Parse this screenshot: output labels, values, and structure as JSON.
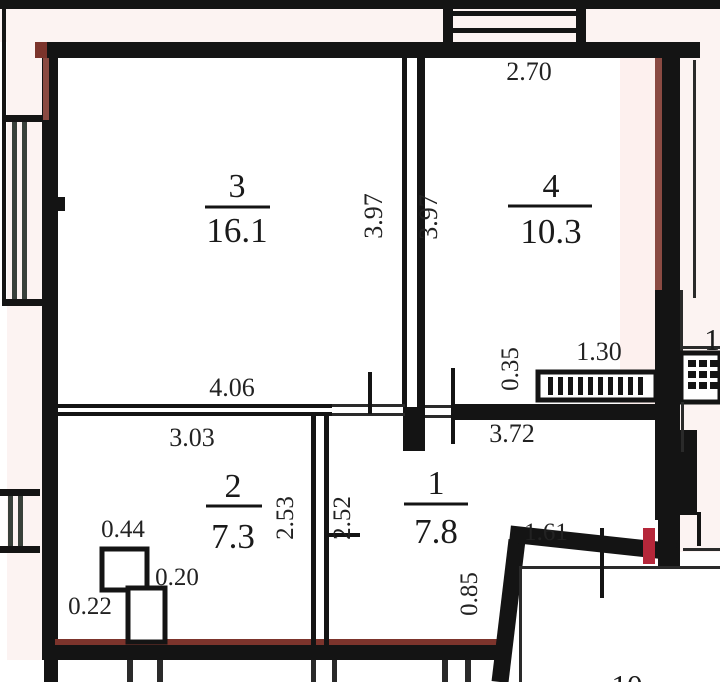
{
  "plan_title": "apartment-floor-plan",
  "rooms": {
    "r3": {
      "number": "3",
      "area": "16.1"
    },
    "r4": {
      "number": "4",
      "area": "10.3"
    },
    "r2": {
      "number": "2",
      "area": "7.3"
    },
    "r1": {
      "number": "1",
      "area": "7.8"
    }
  },
  "dims": {
    "top_room4_width": "2.70",
    "wall34_left_height": "3.97",
    "wall34_right_height": "3.97",
    "room3_width": "4.06",
    "room2_width": "3.03",
    "vent_width": "1.30",
    "vent_offset": "0.35",
    "hall_width": "3.72",
    "duct_top": "0.44",
    "duct_side": "0.20",
    "duct_left": "0.22",
    "room2_depth": "2.53",
    "room1_depth": "2.52",
    "diag_top": "1.61",
    "diag_side": "0.85"
  },
  "neighbors": {
    "right_room": "1",
    "bottom_room": "10"
  },
  "colors": {
    "wall": "#141414",
    "maroon": "#7c342c",
    "maroon_light": "#8a4a42",
    "red": "#b5273a",
    "window": "#38403a",
    "pink": "#fcf3f2",
    "pink_strong": "#fdf0ee",
    "thin": "#2a2a2a"
  }
}
